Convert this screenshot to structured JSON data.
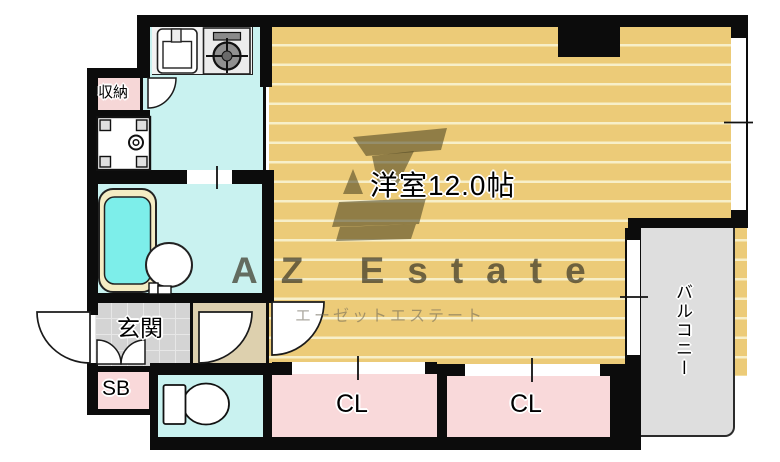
{
  "meta": {
    "type": "apartment-floorplan"
  },
  "rooms": {
    "main": {
      "label": "洋室12.0帖"
    },
    "storage": {
      "label": "収納"
    },
    "entrance": {
      "label": "玄関"
    },
    "shoe_box": {
      "label": "SB"
    },
    "closet1": {
      "label": "CL"
    },
    "closet2": {
      "label": "CL"
    },
    "balcony": {
      "label": "バルコニー"
    }
  },
  "watermark": {
    "brand": "AZ Estate",
    "brand_kana": "エーゼットエステート"
  },
  "fixtures": [
    "kitchen-sink",
    "gas-stove",
    "washing-machine-pan",
    "bathtub",
    "wash-basin",
    "toilet"
  ],
  "colors": {
    "floor_tan": "#eccb78",
    "floor_stripe": "#f7efc9",
    "wet_area_cyan": "#c9f2f0",
    "closet_pink": "#f9d9da",
    "hallway_beige": "#ddd0ae",
    "entrance_tile_gray": "#d6d6d6",
    "balcony_gray": "#dedede",
    "bath_water": "#7deeea",
    "wall_black": "#0b0b0b"
  }
}
